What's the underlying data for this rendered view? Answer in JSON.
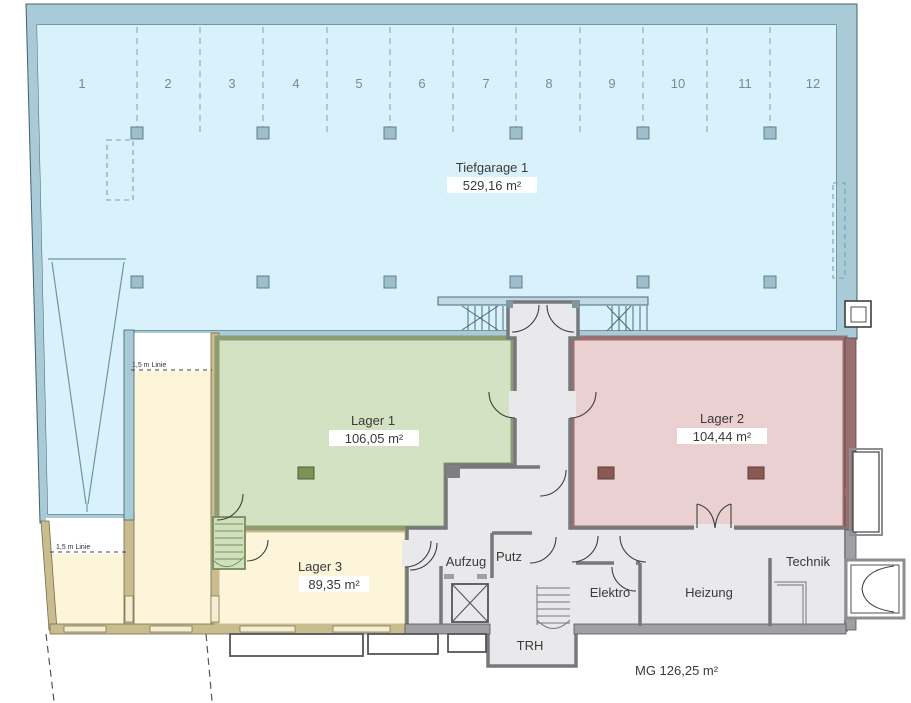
{
  "garage": {
    "label": "Tiefgarage 1",
    "area": "529,16 m²",
    "spaces": [
      "1",
      "2",
      "3",
      "4",
      "5",
      "6",
      "7",
      "8",
      "9",
      "10",
      "11",
      "12"
    ]
  },
  "rooms": {
    "lager1": {
      "label": "Lager 1",
      "area": "106,05 m²"
    },
    "lager2": {
      "label": "Lager 2",
      "area": "104,44 m²"
    },
    "lager3": {
      "label": "Lager 3",
      "area": "89,35 m²"
    },
    "aufzug": {
      "label": "Aufzug"
    },
    "putz": {
      "label": "Putz"
    },
    "trh": {
      "label": "TRH"
    },
    "elektro": {
      "label": "Elektro"
    },
    "heizung": {
      "label": "Heizung"
    },
    "technik": {
      "label": "Technik"
    }
  },
  "annotations": {
    "mg": "MG 126,25 m²",
    "linie": "1,5 m Linie"
  },
  "colors": {
    "garage_fill": "#d9f1fa",
    "garage_wall": "#a9cad7",
    "lager1_fill": "#d3e2c3",
    "lager1_wall": "#8e9c70",
    "lager2_fill": "#ead0d0",
    "lager2_wall": "#9a6f6f",
    "lager3_fill": "#fcf5da",
    "lager3_wall": "#c9bd8f",
    "hall_fill": "#e9e9eb",
    "hall_wall": "#77787c",
    "number_color": "#6e8e9e"
  }
}
